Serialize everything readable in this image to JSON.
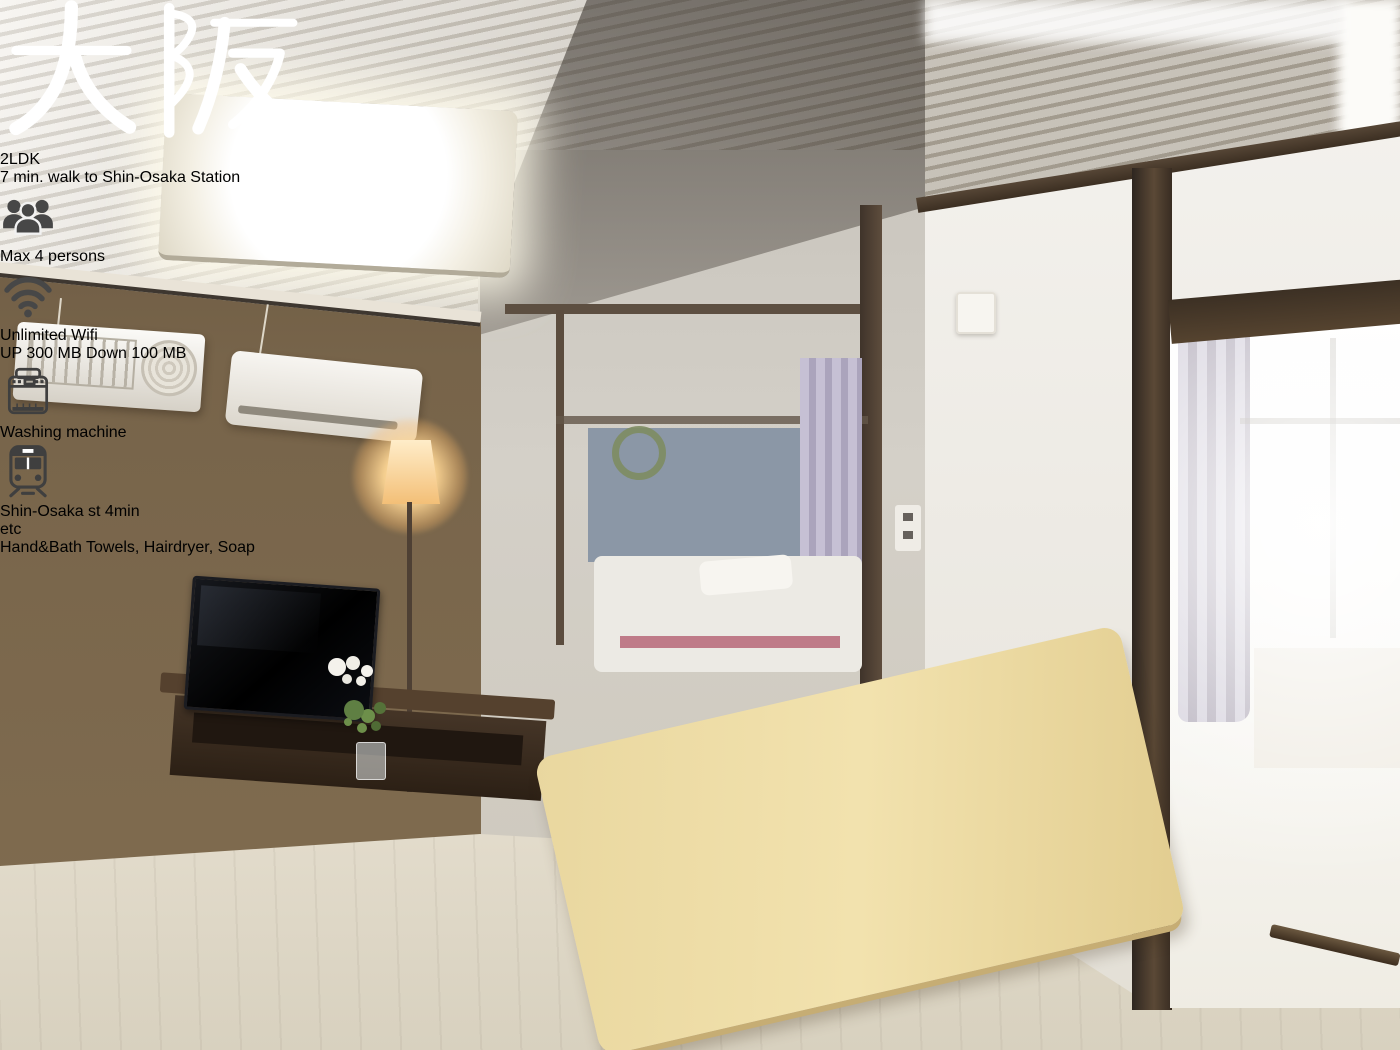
{
  "overlay": {
    "title": "大阪",
    "subtitle": "2LDK",
    "tagline": "7 min. walk to Shin-Osaka Station",
    "amenities": {
      "capacity": {
        "prefix": "Max",
        "value": "4",
        "suffix": "persons"
      },
      "wifi": {
        "label": "Unlimited Wifi",
        "upload": "UP 300 MB",
        "download": "Down 100 MB"
      },
      "laundry": {
        "label": "Washing machine"
      },
      "station": {
        "label": "Shin-Osaka st 4min"
      },
      "extras": {
        "badge": "etc",
        "label": "Hand&Bath Towels, Hairdryer, Soap"
      }
    },
    "colors": {
      "panel_gray": "rgba(96,92,90,0.78)",
      "text": "#ffffff",
      "icon_glyph": "#474747",
      "divider": "#f8f8f8",
      "runner_magenta": "#b9509a",
      "sofa_brown": "#9a5830",
      "wall_brown": "#77644a"
    }
  }
}
